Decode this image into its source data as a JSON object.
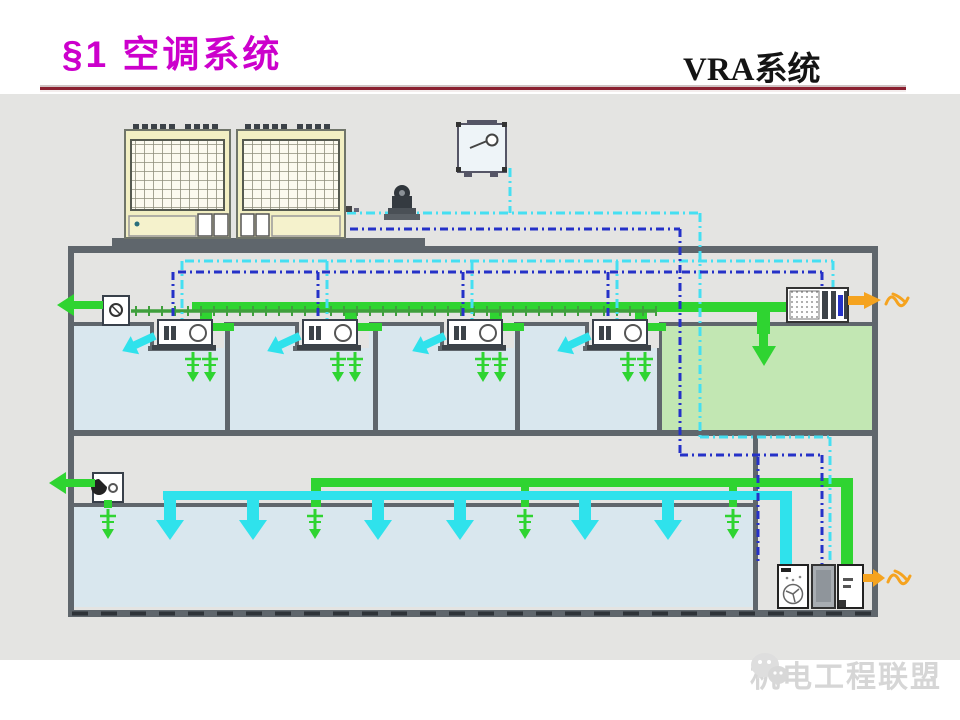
{
  "header": {
    "section_title": "§1 空调系统",
    "page_title": "VRA系统"
  },
  "watermark": {
    "text": "机电工程联盟"
  },
  "icons": {
    "wechat-logo": "two-chat-bubbles",
    "exhaust-arrow": "←",
    "airflow-arrow": "↙",
    "supply-arrow": "↓",
    "fan": "circle-with-blades"
  },
  "colors": {
    "bg_slide": "#ffffff",
    "bg_diagram": "#e4e4e2",
    "title_magenta": "#cc00cc",
    "header_black": "#141414",
    "divider_red": "#8b2030",
    "building_gray": "#5f666c",
    "room_blue": "#d9e7ee",
    "room_green": "#c2e7b3",
    "unit_cream": "#f2efc3",
    "green_bright": "#2fd431",
    "green_dark": "#3f9f3c",
    "cyan_duct": "#2fe2ec",
    "cyan_dash": "#45dff2",
    "blue_dash": "#2531c8",
    "orange": "#f5a31f",
    "dark_equip": "#3c4248",
    "watermark_gray": "#d6d6d6"
  }
}
